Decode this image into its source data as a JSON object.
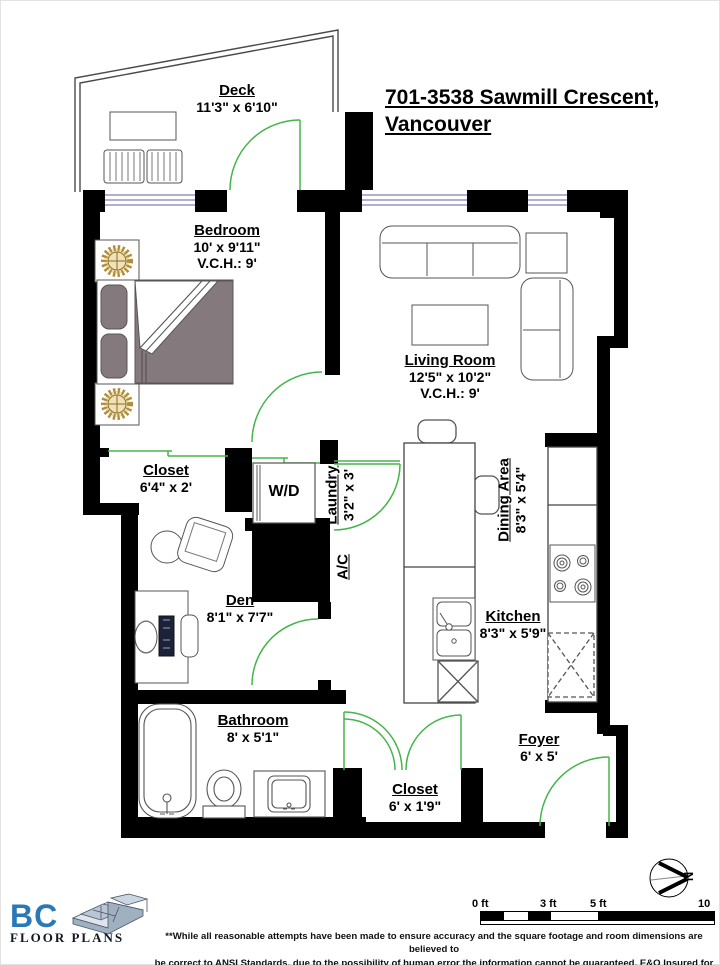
{
  "title": {
    "line1": "701-3538 Sawmill Crescent,",
    "line2": "Vancouver"
  },
  "rooms": [
    {
      "name": "Deck",
      "dims": "11'3\" x 6'10\""
    },
    {
      "name": "Bedroom",
      "dims": "10' x 9'11\"",
      "ceiling": "V.C.H.: 9'"
    },
    {
      "name": "Living Room",
      "dims": "12'5\" x 10'2\"",
      "ceiling": "V.C.H.: 9'"
    },
    {
      "name": "Closet",
      "dims": "6'4\" x 2'"
    },
    {
      "name": "Laundry",
      "dims": "3'2\" x 3'"
    },
    {
      "name": "Den",
      "dims": "8'1\" x 7'7\""
    },
    {
      "name": "Dining Area",
      "dims": "8'3\" x 5'4\""
    },
    {
      "name": "Kitchen",
      "dims": "8'3\" x 5'9\""
    },
    {
      "name": "Bathroom",
      "dims": "8' x 5'1\""
    },
    {
      "name": "Closet",
      "dims": "6' x 1'9\""
    },
    {
      "name": "Foyer",
      "dims": "6' x 5'"
    }
  ],
  "fixtures": {
    "washer_dryer": "W/D",
    "air_conditioning": "A/C"
  },
  "compass": {
    "north": "N"
  },
  "scale_bar": {
    "ticks": [
      "0 ft",
      "3 ft",
      "5 ft",
      "10 ft"
    ]
  },
  "logo": {
    "brand": "BC",
    "sub": "FLOOR PLANS"
  },
  "disclaimer": {
    "line1": "**While all reasonable attempts have been made to ensure accuracy and the square footage and room dimensions are believed to",
    "line2": "be correct to ANSI Standards, due to the possibility of human error the information cannot be guaranteed. E&O Insured for $1,000,000"
  },
  "colors": {
    "wall": "#000000",
    "door_green": "#46b549",
    "window_blue": "#8080bb",
    "furniture_gray": "#847a7e",
    "lamp_gold": "#c8a34c",
    "logo_blue": "#2979b8"
  }
}
